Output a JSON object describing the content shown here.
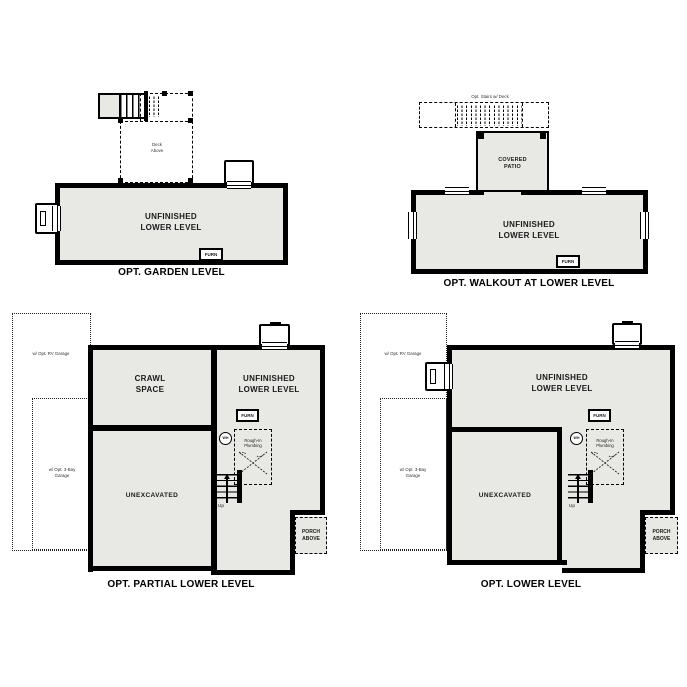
{
  "colors": {
    "wall": "#000000",
    "floor_fill": "#e8e8e5",
    "background": "#ffffff",
    "text": "#1a1a1a"
  },
  "icons": {
    "up_arrow": "triangle-up",
    "water_heater": "circle-WH",
    "stairs": "tread-lines",
    "window": "triple-line",
    "deck_post": "filled-square"
  },
  "plans": {
    "garden": {
      "caption": "OPT. GARDEN LEVEL",
      "room_line1": "UNFINISHED",
      "room_line2": "LOWER LEVEL",
      "furn": "FURN",
      "deck_line1": "Deck",
      "deck_line2": "Above"
    },
    "walkout": {
      "caption": "OPT. WALKOUT AT LOWER LEVEL",
      "room_line1": "UNFINISHED",
      "room_line2": "LOWER LEVEL",
      "furn": "FURN",
      "patio_line1": "COVERED",
      "patio_line2": "PATIO",
      "deck_note": "Opt. Stairs w/ Deck"
    },
    "partial": {
      "caption": "OPT. PARTIAL LOWER LEVEL",
      "crawl_line1": "CRAWL",
      "crawl_line2": "SPACE",
      "room_line1": "UNFINISHED",
      "room_line2": "LOWER LEVEL",
      "unexcavated": "UNEXCAVATED",
      "furn": "FURN",
      "wh": "WH",
      "rough_line1": "Rough-In",
      "rough_line2": "Plumbing",
      "up": "Up",
      "porch_line1": "PORCH",
      "porch_line2": "ABOVE",
      "rv_garage": "w/ Opt. RV Garage",
      "bay_garage_line1": "w/ Opt. 3-Bay",
      "bay_garage_line2": "Garage"
    },
    "lower": {
      "caption": "OPT. LOWER LEVEL",
      "room_line1": "UNFINISHED",
      "room_line2": "LOWER LEVEL",
      "unexcavated": "UNEXCAVATED",
      "furn": "FURN",
      "wh": "WH",
      "rough_line1": "Rough-In",
      "rough_line2": "Plumbing",
      "up": "Up",
      "porch_line1": "PORCH",
      "porch_line2": "ABOVE",
      "rv_garage": "w/ Opt. RV Garage",
      "bay_garage_line1": "w/ Opt. 3-Bay",
      "bay_garage_line2": "Garage"
    }
  }
}
